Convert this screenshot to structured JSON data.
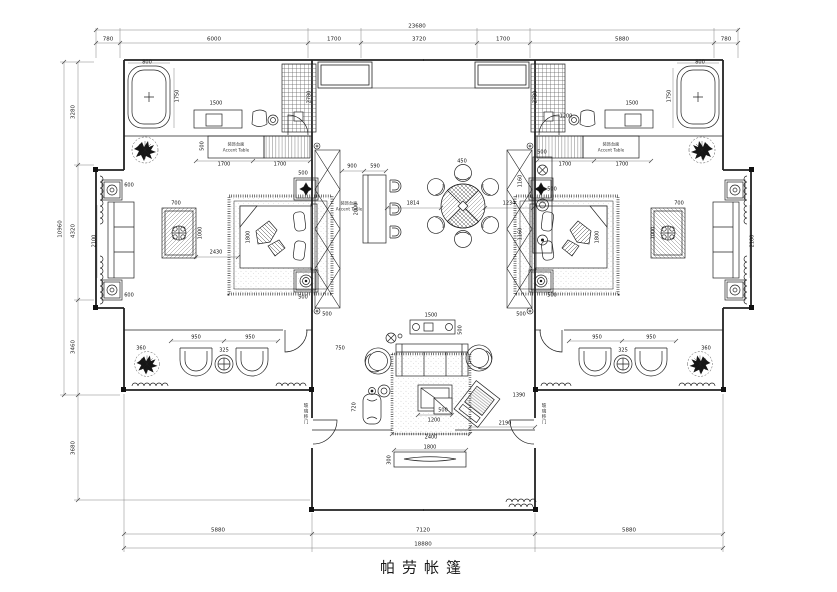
{
  "title": "帕劳帐篷",
  "colors": {
    "line": "#1a1a1a",
    "dim_text": "#111111",
    "background": "#ffffff"
  },
  "dims": {
    "top_total": "23680",
    "top": [
      "780",
      "6000",
      "1700",
      "3720",
      "1700",
      "5880",
      "780"
    ],
    "bottom": [
      "5880",
      "7120",
      "5880"
    ],
    "bottom_total": "18880",
    "left": [
      "3280",
      "4320",
      "3460",
      "3680"
    ],
    "left_total": "10960",
    "inner": [
      "800",
      "1750",
      "1500",
      "2780",
      "500",
      "1700",
      "1700",
      "600",
      "2100",
      "600",
      "700",
      "1000",
      "2430",
      "1800",
      "500",
      "500",
      "900",
      "590",
      "2000",
      "1814",
      "450",
      "1234",
      "1160",
      "1160",
      "500",
      "500",
      "500",
      "500",
      "500",
      "1800",
      "700",
      "1000",
      "2100",
      "1500",
      "1750",
      "800",
      "1700",
      "1700",
      "1200",
      "2780",
      "360",
      "950",
      "325",
      "950",
      "950",
      "325",
      "950",
      "360",
      "1500",
      "500",
      "750",
      "1200",
      "500",
      "2400",
      "1390",
      "2190",
      "720",
      "1800",
      "300"
    ]
  },
  "labels": {
    "accent_cn": "装饰台面",
    "accent_en": "Accent Table",
    "door": "玻璃移门"
  }
}
